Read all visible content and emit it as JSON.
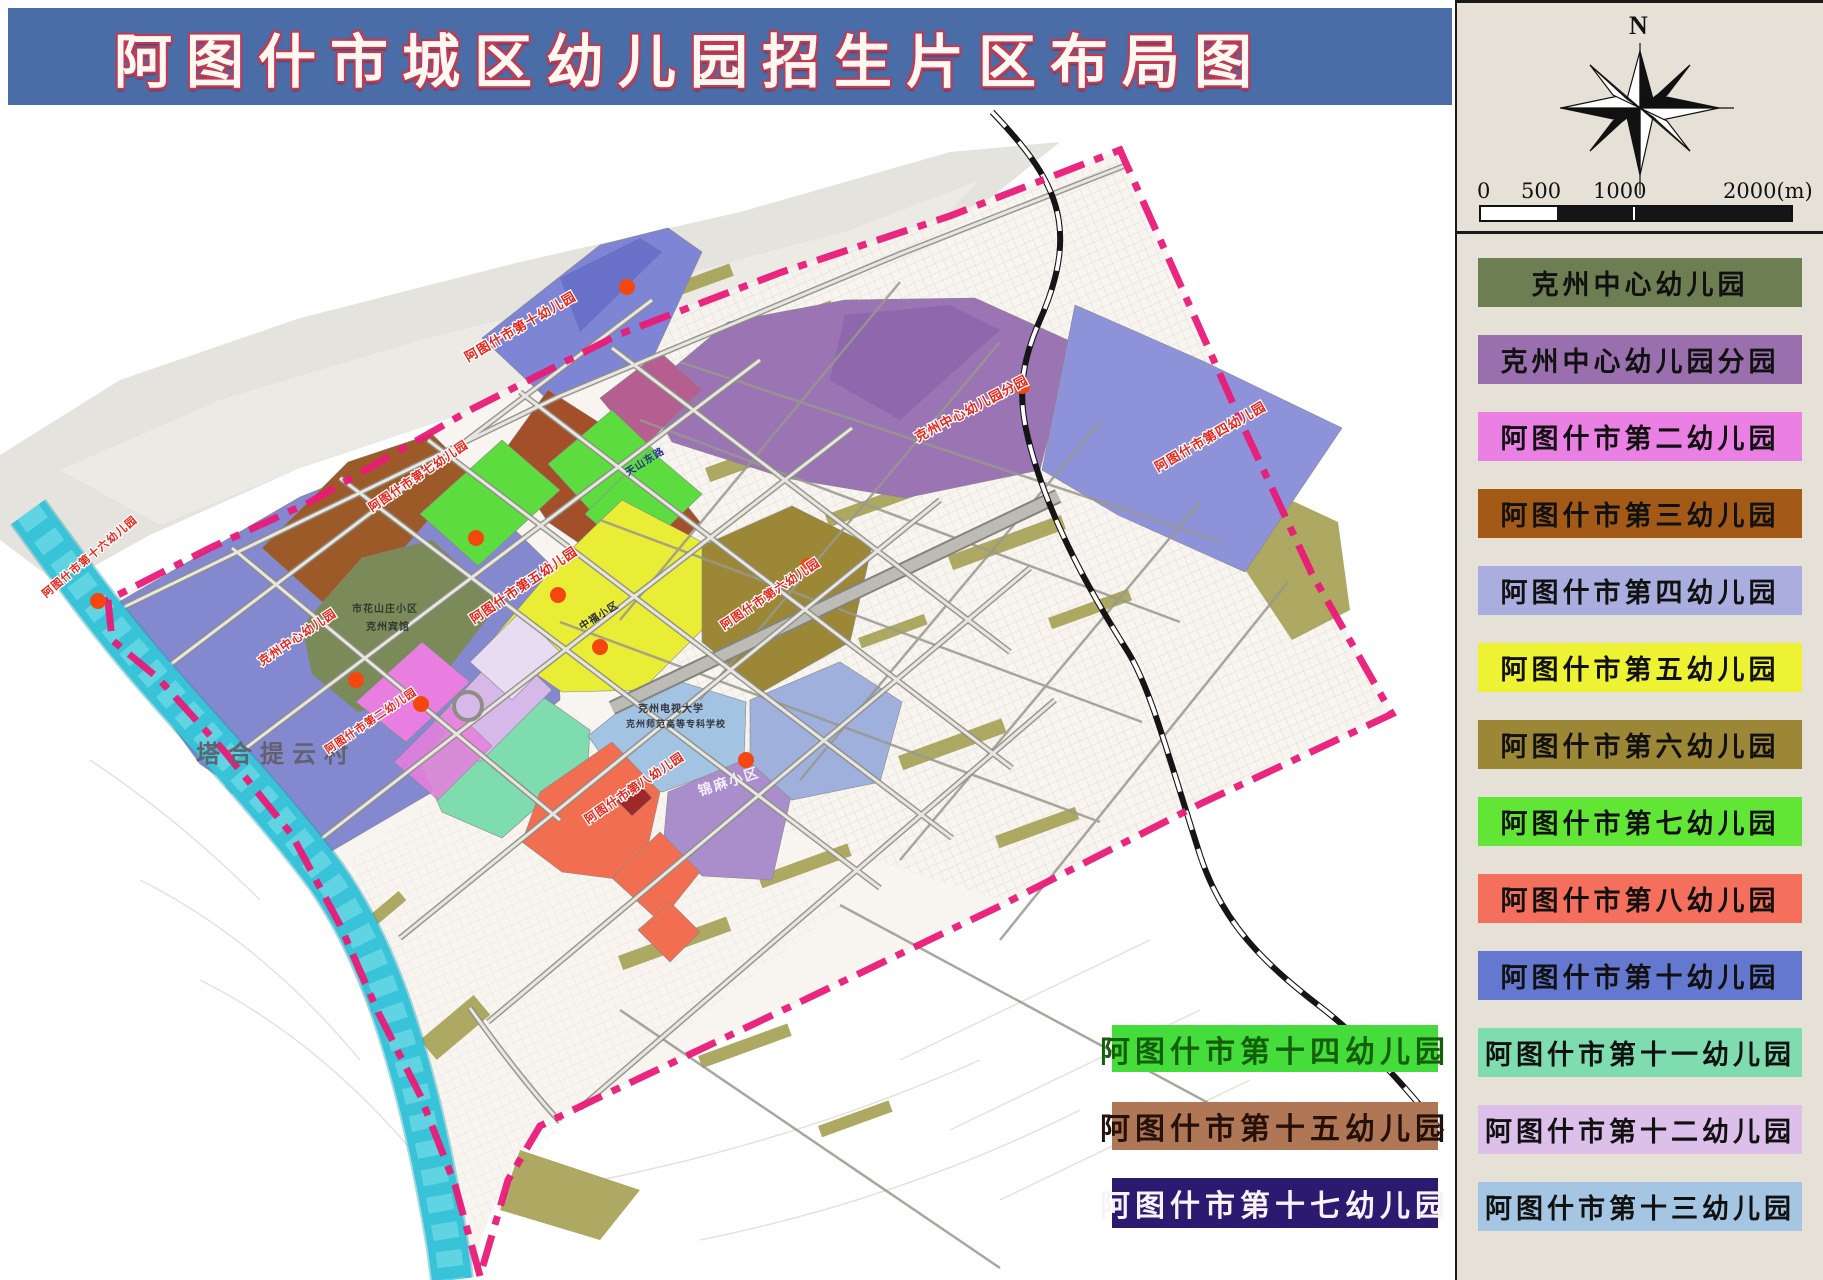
{
  "title": {
    "text": "阿图什市城区幼儿园招生片区布局图"
  },
  "sidebar": {
    "compass_label": "N",
    "scale_ticks": [
      "0",
      "500",
      "1000",
      "2000(m)"
    ],
    "legend": [
      {
        "label": "克州中心幼儿园",
        "color": "#6d7f52",
        "text_color": "#111111"
      },
      {
        "label": "克州中心幼儿园分园",
        "color": "#9a6fae",
        "text_color": "#111111"
      },
      {
        "label": "阿图什市第二幼儿园",
        "color": "#ea7fe4",
        "text_color": "#111111"
      },
      {
        "label": "阿图什市第三幼儿园",
        "color": "#a35a17",
        "text_color": "#111111"
      },
      {
        "label": "阿图什市第四幼儿园",
        "color": "#a9aede",
        "text_color": "#111111"
      },
      {
        "label": "阿图什市第五幼儿园",
        "color": "#edf233",
        "text_color": "#111111"
      },
      {
        "label": "阿图什市第六幼儿园",
        "color": "#9c8736",
        "text_color": "#111111"
      },
      {
        "label": "阿图什市第七幼儿园",
        "color": "#62e636",
        "text_color": "#111111"
      },
      {
        "label": "阿图什市第八幼儿园",
        "color": "#f5705c",
        "text_color": "#111111"
      },
      {
        "label": "阿图什市第十幼儿园",
        "color": "#6478d0",
        "text_color": "#111111"
      },
      {
        "label": "阿图什市第十一幼儿园",
        "color": "#7edcae",
        "text_color": "#111111"
      },
      {
        "label": "阿图什市第十二幼儿园",
        "color": "#dcc0ea",
        "text_color": "#111111"
      },
      {
        "label": "阿图什市第十三幼儿园",
        "color": "#a5c6e2",
        "text_color": "#111111"
      }
    ]
  },
  "overlay_boxes": [
    {
      "label": "阿图什市第十四幼儿园",
      "color": "#44dd3b",
      "text_color": "#14600a",
      "top": 1025,
      "left": 1112,
      "height": 47
    },
    {
      "label": "阿图什市第十五幼儿园",
      "color": "#b07756",
      "text_color": "#26100a",
      "top": 1102,
      "left": 1112,
      "height": 48
    },
    {
      "label": "阿图什市第十七幼儿园",
      "color": "#2b1a70",
      "text_color": "#f7f3fa",
      "top": 1178,
      "left": 1112,
      "height": 50
    }
  ],
  "map": {
    "colors": {
      "boundary": "#ea1a77",
      "river": "#38c3d8",
      "railway": "#151515",
      "dot": "#f4470f"
    },
    "place_labels": [
      {
        "text": "塔合提云村",
        "x": 196,
        "y": 762,
        "rot": 0,
        "size": 24,
        "color": "#62626f",
        "spacing": 8
      },
      {
        "text": "锦麻小区",
        "x": 700,
        "y": 796,
        "rot": -18,
        "size": 14,
        "color": "#f2eef8",
        "spacing": 2
      },
      {
        "text": "克州电视大学",
        "x": 638,
        "y": 712,
        "rot": 0,
        "size": 10,
        "color": "#33343f",
        "spacing": 1
      },
      {
        "text": "克州师范高等专科学校",
        "x": 626,
        "y": 727,
        "rot": 0,
        "size": 9,
        "color": "#33343f",
        "spacing": 0
      },
      {
        "text": "市花山庄小区",
        "x": 352,
        "y": 612,
        "rot": 0,
        "size": 10,
        "color": "#2e3b2e",
        "spacing": 1
      },
      {
        "text": "克州宾馆",
        "x": 366,
        "y": 630,
        "rot": 0,
        "size": 10,
        "color": "#2e3b2e",
        "spacing": 1
      },
      {
        "text": "中福小区",
        "x": 582,
        "y": 630,
        "rot": -32,
        "size": 10,
        "color": "#2b2b3d",
        "spacing": 1
      },
      {
        "text": "天山东路",
        "x": 628,
        "y": 476,
        "rot": -32,
        "size": 10,
        "color": "#27308f",
        "spacing": 1
      }
    ],
    "red_labels": [
      {
        "text": "阿图什市第十六幼儿园",
        "x": 46,
        "y": 598,
        "rot": -40,
        "size": 11
      },
      {
        "text": "阿图什市第十幼儿园",
        "x": 468,
        "y": 362,
        "rot": -30,
        "size": 13
      },
      {
        "text": "克州中心幼儿园分园",
        "x": 918,
        "y": 442,
        "rot": -28,
        "size": 13
      },
      {
        "text": "阿图什市第四幼儿园",
        "x": 1158,
        "y": 472,
        "rot": -30,
        "size": 13
      },
      {
        "text": "阿图什市第七幼儿园",
        "x": 372,
        "y": 512,
        "rot": -34,
        "size": 12
      },
      {
        "text": "阿图什市第五幼儿园",
        "x": 474,
        "y": 624,
        "rot": -34,
        "size": 13
      },
      {
        "text": "阿图什市第六幼儿园",
        "x": 724,
        "y": 630,
        "rot": -34,
        "size": 12
      },
      {
        "text": "克州中心幼儿园",
        "x": 262,
        "y": 666,
        "rot": -34,
        "size": 12
      },
      {
        "text": "阿图什市第二幼儿园",
        "x": 328,
        "y": 754,
        "rot": -34,
        "size": 11
      },
      {
        "text": "阿图什市第八幼儿园",
        "x": 588,
        "y": 824,
        "rot": -34,
        "size": 12
      }
    ],
    "dots": [
      [
        98,
        601
      ],
      [
        356,
        680
      ],
      [
        421,
        704
      ],
      [
        476,
        538
      ],
      [
        558,
        595
      ],
      [
        600,
        647
      ],
      [
        808,
        566
      ],
      [
        1022,
        386
      ],
      [
        627,
        287
      ],
      [
        746,
        760
      ]
    ]
  }
}
